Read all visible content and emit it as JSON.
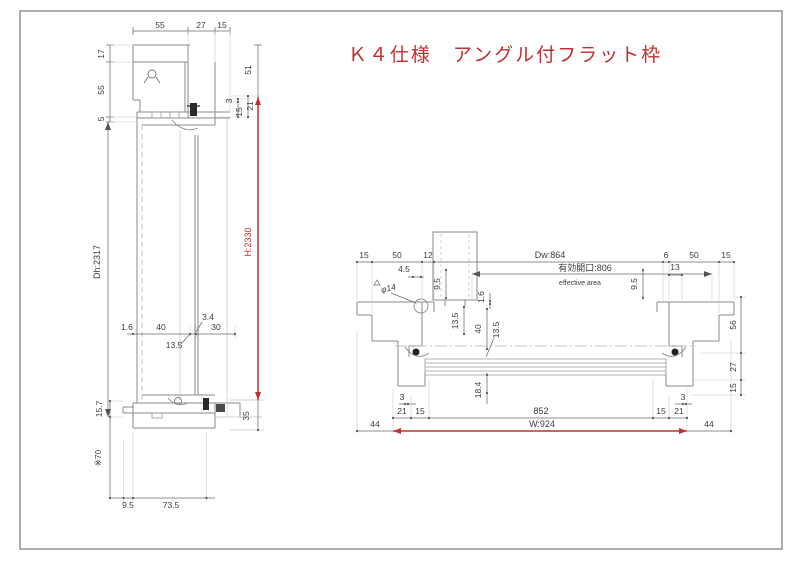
{
  "title": "Ｋ４仕様　アングル付フラット枠",
  "colors": {
    "accent_red": "#c1302e",
    "dim_text": "#3b3b3b",
    "profile_line": "#8a8a8a",
    "border": "#777777"
  },
  "vertical_section": {
    "top_widths": {
      "w1": "55",
      "w2": "27",
      "w3": "15"
    },
    "left_heights": {
      "h1": "17",
      "h2": "55",
      "h3": "5"
    },
    "door_height": "Dh:2317",
    "frame_height": "H:2330",
    "right_top": {
      "d51": "51",
      "d3": "3",
      "d21": "21",
      "d15": "15"
    },
    "mid": {
      "d16": "1.6",
      "d40": "40",
      "d34": "3.4",
      "d30": "30",
      "d135": "13.5"
    },
    "bottom": {
      "d157": "15.7",
      "d70": "※70",
      "d95": "9.5",
      "d735": "73.5",
      "d35": "35"
    }
  },
  "horizontal_section": {
    "top": {
      "l15": "15",
      "l50": "50",
      "l12": "12",
      "dw": "Dw:864",
      "eff": "有効開口:806",
      "eff_en": "effective area",
      "r6": "6",
      "r50": "50",
      "r15": "15"
    },
    "detail": {
      "d45": "4.5",
      "phi14": "φ14",
      "l95": "9.5",
      "r95": "9.5",
      "d13": "13",
      "d16": "1.6",
      "d135a": "13.5",
      "d40": "40",
      "d135b": "13.5",
      "d184": "18.4"
    },
    "right": {
      "d56": "56",
      "d27": "27",
      "d15": "15"
    },
    "bottom": {
      "l3": "3",
      "l21": "21",
      "l15": "15",
      "d852": "852",
      "r15": "15",
      "r21": "21",
      "r3": "3",
      "l44": "44",
      "r44": "44",
      "w": "W:924"
    }
  }
}
